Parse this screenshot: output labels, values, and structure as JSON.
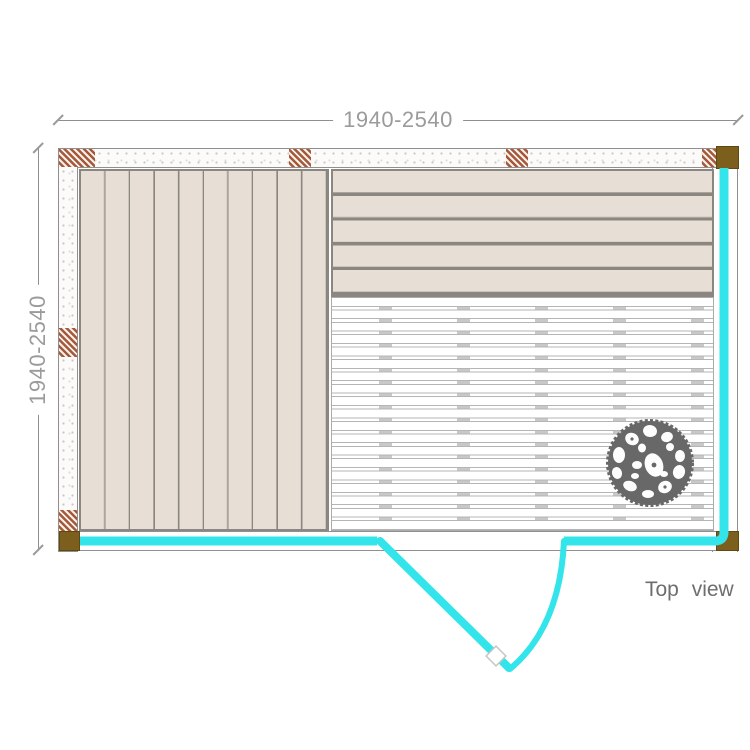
{
  "drawing": {
    "width_dimension": "1940-2540",
    "depth_dimension": "1940-2540",
    "view_label": "Top view"
  },
  "colors": {
    "glass_wall": "#33e4ea",
    "wood_plank": "#e7dfd6",
    "plank_gap_dark": "#8b8780",
    "plank_gap_light": "#c9c4bc",
    "wall_stud_hatch": "#a4593c",
    "corner_post": "#7d5f1d",
    "floor_slat_line": "#b5b5b5",
    "floor_support": "#c8c8c8",
    "heater_stone": "#686868",
    "wall_outline": "#8f8f8f",
    "dimension_text": "#9b9b9b",
    "caption_text": "#6e6e6e"
  }
}
